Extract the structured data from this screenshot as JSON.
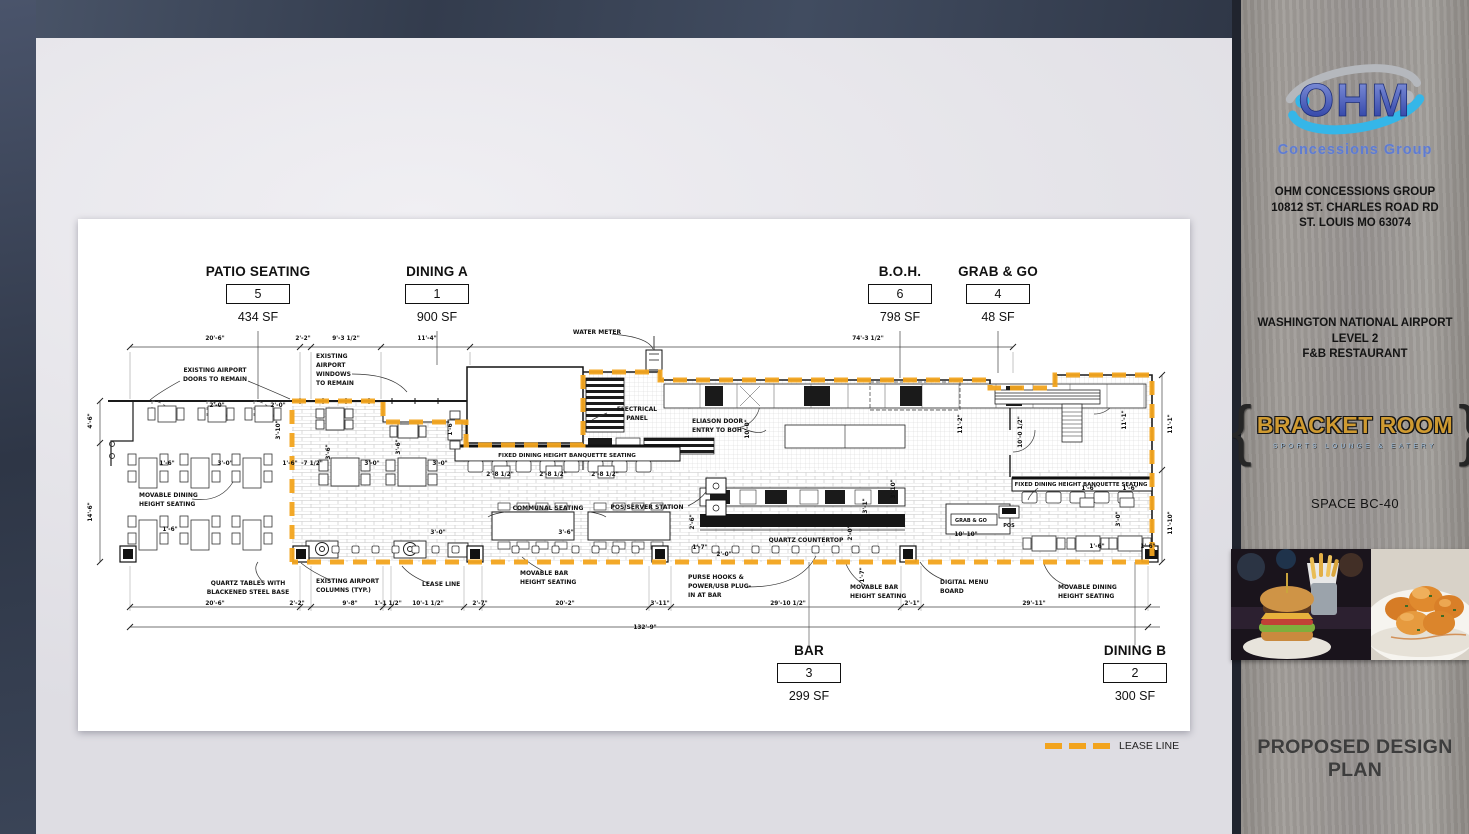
{
  "colors": {
    "lease": "#F2A41E",
    "navy": "#39424f",
    "paper": "#e8e7ea",
    "wood": "#9a9692"
  },
  "legend": {
    "label": "LEASE LINE"
  },
  "zones": [
    {
      "name": "PATIO SEATING",
      "number": "5",
      "area": "434 SF"
    },
    {
      "name": "DINING A",
      "number": "1",
      "area": "900 SF"
    },
    {
      "name": "B.O.H.",
      "number": "6",
      "area": "798 SF"
    },
    {
      "name": "GRAB & GO",
      "number": "4",
      "area": "48 SF"
    },
    {
      "name": "BAR",
      "number": "3",
      "area": "299 SF"
    },
    {
      "name": "DINING B",
      "number": "2",
      "area": "300 SF"
    }
  ],
  "sidebar": {
    "brand": "OHM",
    "brand_subtitle": "Concessions Group",
    "address_lines": [
      "OHM CONCESSIONS GROUP",
      "10812 ST. CHARLES ROAD RD",
      "ST. LOUIS MO 63074"
    ],
    "project_lines": [
      "WASHINGTON NATIONAL AIRPORT",
      "LEVEL 2",
      "F&B RESTAURANT"
    ],
    "venue_name": "BRACKET ROOM",
    "venue_tagline": "SPORTS LOUNGE & EATERY",
    "space_label": "SPACE BC-40",
    "photo_names": [
      "burger-and-fries-photo",
      "fried-shrimp-photo"
    ],
    "footer": "PROPOSED DESIGN PLAN"
  },
  "plan": {
    "annotations": [
      {
        "t": [
          "EXISTING AIRPORT",
          "DOORS TO REMAIN"
        ],
        "x": 215,
        "y": 372,
        "a": "m"
      },
      {
        "t": [
          "EXISTING",
          "AIRPORT",
          "WINDOWS",
          "TO REMAIN"
        ],
        "x": 316,
        "y": 358,
        "a": "s"
      },
      {
        "t": [
          "WATER METER"
        ],
        "x": 597,
        "y": 334,
        "a": "m"
      },
      {
        "t": [
          "ELECTRICAL",
          "PANEL"
        ],
        "x": 637,
        "y": 411,
        "a": "m"
      },
      {
        "t": [
          "ELIASON DOOR",
          "ENTRY TO BOH"
        ],
        "x": 692,
        "y": 423,
        "a": "s"
      },
      {
        "t": [
          "FIXED DINING HEIGHT BANQUETTE SEATING"
        ],
        "x": 567,
        "y": 457,
        "a": "m",
        "fs": 5.6
      },
      {
        "t": [
          "COMMUNAL SEATING"
        ],
        "x": 548,
        "y": 510,
        "a": "m"
      },
      {
        "t": [
          "POS/SERVER STATION"
        ],
        "x": 647,
        "y": 509,
        "a": "m"
      },
      {
        "t": [
          "QUARTZ COUNTERTOP"
        ],
        "x": 806,
        "y": 542,
        "a": "m"
      },
      {
        "t": [
          "FIXED DINING HEIGHT BANQUETTE SEATING"
        ],
        "x": 1081,
        "y": 486,
        "a": "m",
        "fs": 5.4
      },
      {
        "t": [
          "MOVABLE DINING",
          "HEIGHT SEATING"
        ],
        "x": 139,
        "y": 497,
        "a": "s"
      },
      {
        "t": [
          "QUARTZ TABLES WITH",
          "BLACKENED STEEL BASE"
        ],
        "x": 248,
        "y": 585,
        "a": "m"
      },
      {
        "t": [
          "EXISTING AIRPORT",
          "COLUMNS (TYP.)"
        ],
        "x": 316,
        "y": 583,
        "a": "s"
      },
      {
        "t": [
          "MOVABLE BAR",
          "HEIGHT SEATING"
        ],
        "x": 520,
        "y": 575,
        "a": "s"
      },
      {
        "t": [
          "PURSE HOOKS &",
          "POWER/USB PLUG-",
          "IN AT BAR"
        ],
        "x": 688,
        "y": 579,
        "a": "s"
      },
      {
        "t": [
          "LEASE LINE"
        ],
        "x": 422,
        "y": 586,
        "a": "s"
      },
      {
        "t": [
          "MOVABLE BAR",
          "HEIGHT SEATING"
        ],
        "x": 850,
        "y": 589,
        "a": "s"
      },
      {
        "t": [
          "DIGITAL MENU",
          "BOARD"
        ],
        "x": 940,
        "y": 584,
        "a": "s"
      },
      {
        "t": [
          "MOVABLE DINING",
          "HEIGHT  SEATING"
        ],
        "x": 1058,
        "y": 589,
        "a": "s"
      },
      {
        "t": [
          "GRAB & GO"
        ],
        "x": 955,
        "y": 522,
        "a": "s",
        "fs": 5
      },
      {
        "t": [
          "POS"
        ],
        "x": 1009,
        "y": 527,
        "a": "m",
        "fs": 5
      }
    ],
    "dimensions": [
      [
        "20'-6\"",
        215,
        340,
        0
      ],
      [
        "2'-2\"",
        303,
        340,
        0
      ],
      [
        "9'-3 1/2\"",
        346,
        340,
        0
      ],
      [
        "11'-4\"",
        427,
        340,
        0
      ],
      [
        "74'-3 1/2\"",
        868,
        340,
        0
      ],
      [
        "4'-6\"",
        92,
        421,
        1
      ],
      [
        "14'-6\"",
        92,
        512,
        1
      ],
      [
        "11'-1\"",
        1172,
        424,
        1
      ],
      [
        "11'-10\"",
        1172,
        523,
        1
      ],
      [
        "11'-1\"",
        1126,
        420,
        1
      ],
      [
        "10'-0 1/2\"",
        1022,
        432,
        1
      ],
      [
        "20'-6\"",
        215,
        605,
        0
      ],
      [
        "2'-2\"",
        297,
        605,
        0
      ],
      [
        "9'-8\"",
        350,
        605,
        0
      ],
      [
        "1'-1 1/2\"",
        388,
        605,
        0
      ],
      [
        "10'-1 1/2\"",
        428,
        605,
        0
      ],
      [
        "2'-7\"",
        480,
        605,
        0
      ],
      [
        "20'-2\"",
        565,
        605,
        0
      ],
      [
        "3'-11\"",
        660,
        605,
        0
      ],
      [
        "29'-10 1/2\"",
        788,
        605,
        0
      ],
      [
        "2'-1\"",
        912,
        605,
        0
      ],
      [
        "29'-11\"",
        1034,
        605,
        0
      ],
      [
        "132'-9\"",
        645,
        629,
        0
      ],
      [
        "2'-0\"",
        217,
        407,
        0
      ],
      [
        "2'-0\"",
        278,
        407,
        0
      ],
      [
        "3'-10\"",
        280,
        430,
        1
      ],
      [
        "1'-6\"",
        167,
        465,
        0
      ],
      [
        "3'-0\"",
        225,
        465,
        0
      ],
      [
        "1'-6\"",
        290,
        465,
        0
      ],
      [
        "-7 1/2\"",
        312,
        465,
        0
      ],
      [
        "3'-6\"",
        330,
        452,
        1
      ],
      [
        "3'-0\"",
        372,
        465,
        0
      ],
      [
        "3'-6\"",
        400,
        447,
        1
      ],
      [
        "3'-0\"",
        440,
        465,
        0
      ],
      [
        "1'-6\"",
        452,
        428,
        1
      ],
      [
        "1'-6\"",
        170,
        531,
        0
      ],
      [
        "3'-0\"",
        438,
        534,
        0
      ],
      [
        "2'-8 1/2\"",
        500,
        476,
        0
      ],
      [
        "2'-8 1/2\"",
        553,
        476,
        0
      ],
      [
        "2'-8 1/2\"",
        605,
        476,
        0
      ],
      [
        "3'-6\"",
        566,
        534,
        0
      ],
      [
        "2'-6\"",
        694,
        522,
        1
      ],
      [
        "1'-7\"",
        700,
        549,
        0
      ],
      [
        "2'-0\"",
        724,
        556,
        0
      ],
      [
        "10'-0\"",
        749,
        429,
        1
      ],
      [
        "11'-2\"",
        962,
        424,
        1
      ],
      [
        "3'-10\"",
        895,
        489,
        1
      ],
      [
        "3'-1\"",
        867,
        506,
        1
      ],
      [
        "2'-0\"",
        852,
        533,
        1
      ],
      [
        "10'-10\"",
        966,
        536,
        0
      ],
      [
        "1'-6\"",
        1089,
        490,
        0
      ],
      [
        "1'-6\"",
        1130,
        490,
        0
      ],
      [
        "3'-0\"",
        1120,
        519,
        1
      ],
      [
        "1'-6\"",
        1097,
        548,
        0
      ],
      [
        "1'-6\"",
        1148,
        548,
        0
      ],
      [
        "1'-7\"",
        864,
        575,
        1
      ]
    ]
  }
}
